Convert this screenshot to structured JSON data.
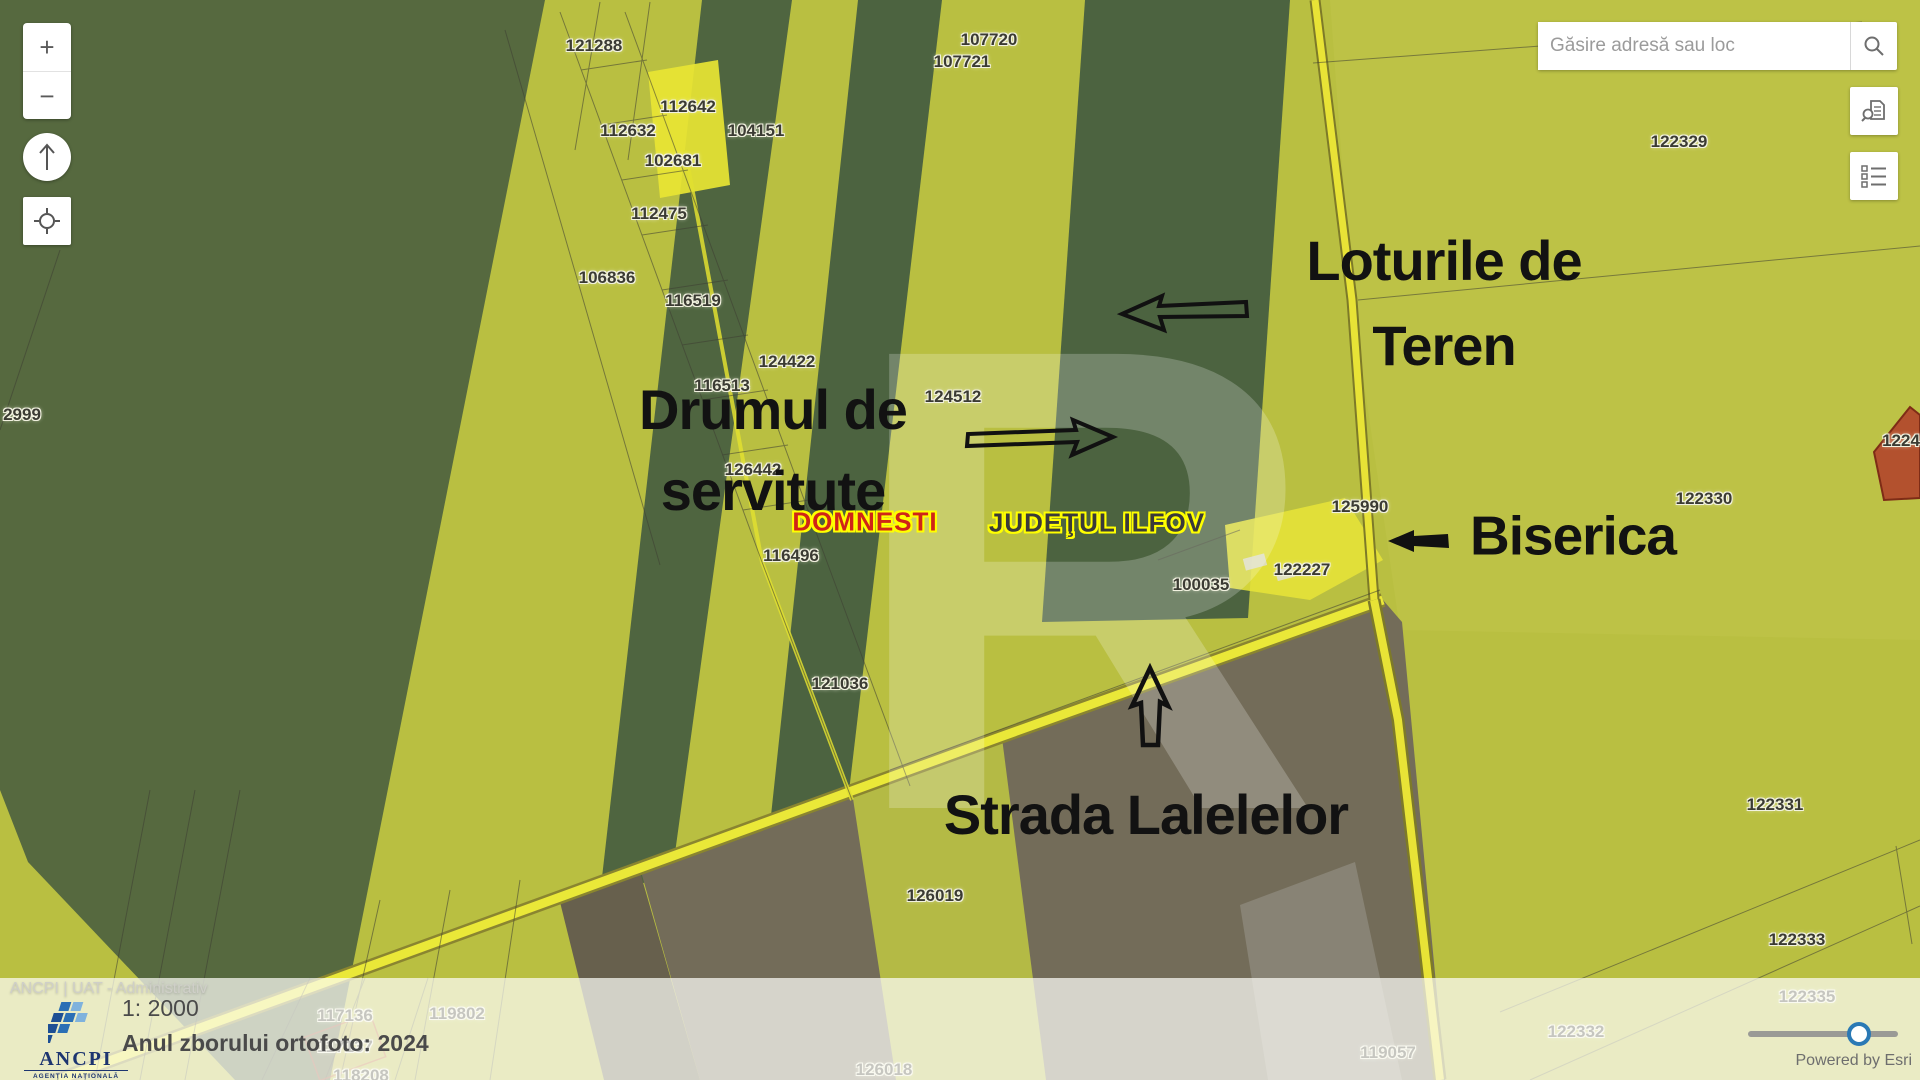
{
  "search": {
    "placeholder": "Găsire adresă sau loc"
  },
  "controls": {
    "zoom_in_label": "+",
    "zoom_out_label": "−",
    "icons": [
      "north-arrow-icon",
      "locate-icon",
      "search-icon",
      "doc-search-icon",
      "legend-icon"
    ]
  },
  "map": {
    "watermark_text": "R",
    "parcels": [
      {
        "n": "121288",
        "x": 594,
        "y": 46
      },
      {
        "n": "107720",
        "x": 989,
        "y": 40
      },
      {
        "n": "107721",
        "x": 962,
        "y": 62
      },
      {
        "n": "112642",
        "x": 688,
        "y": 107
      },
      {
        "n": "112632",
        "x": 628,
        "y": 131
      },
      {
        "n": "104151",
        "x": 756,
        "y": 131
      },
      {
        "n": "102681",
        "x": 673,
        "y": 161
      },
      {
        "n": "112475",
        "x": 659,
        "y": 214
      },
      {
        "n": "106836",
        "x": 607,
        "y": 278
      },
      {
        "n": "116519",
        "x": 693,
        "y": 301
      },
      {
        "n": "124422",
        "x": 787,
        "y": 362
      },
      {
        "n": "116513",
        "x": 722,
        "y": 386
      },
      {
        "n": "124512",
        "x": 953,
        "y": 397
      },
      {
        "n": "126442",
        "x": 753,
        "y": 470
      },
      {
        "n": "116496",
        "x": 791,
        "y": 556
      },
      {
        "n": "2999",
        "x": 22,
        "y": 415
      },
      {
        "n": "125990",
        "x": 1360,
        "y": 507
      },
      {
        "n": "122227",
        "x": 1302,
        "y": 570
      },
      {
        "n": "100035",
        "x": 1201,
        "y": 585
      },
      {
        "n": "121036",
        "x": 840,
        "y": 684
      },
      {
        "n": "126019",
        "x": 935,
        "y": 896
      },
      {
        "n": "122329",
        "x": 1679,
        "y": 142
      },
      {
        "n": "122330",
        "x": 1704,
        "y": 499
      },
      {
        "n": "1224",
        "x": 1901,
        "y": 441
      },
      {
        "n": "122331",
        "x": 1775,
        "y": 805
      },
      {
        "n": "122333",
        "x": 1797,
        "y": 940
      },
      {
        "n": "122335",
        "x": 1807,
        "y": 997
      },
      {
        "n": "122332",
        "x": 1576,
        "y": 1032
      },
      {
        "n": "119057",
        "x": 1388,
        "y": 1053
      },
      {
        "n": "126018",
        "x": 884,
        "y": 1070
      },
      {
        "n": "119802",
        "x": 457,
        "y": 1014
      },
      {
        "n": "117136",
        "x": 345,
        "y": 1016
      },
      {
        "n": "117137",
        "x": 345,
        "y": 1047
      },
      {
        "n": "118208",
        "x": 361,
        "y": 1076
      }
    ],
    "annotations": [
      {
        "id": "loturile-de-teren",
        "lines": [
          "Loturile de",
          "Teren"
        ],
        "x": 1444,
        "y": 303,
        "size": 56,
        "line_height": 85
      },
      {
        "id": "drumul-de-servitute",
        "lines": [
          "Drumul de",
          "servitute"
        ],
        "x": 773,
        "y": 450,
        "size": 56,
        "line_height": 81
      },
      {
        "id": "biserica",
        "lines": [
          "Biserica"
        ],
        "x": 1573,
        "y": 536,
        "size": 55,
        "line_height": 55
      },
      {
        "id": "strada-lalelelor",
        "lines": [
          "Strada Lalelelor"
        ],
        "x": 1146,
        "y": 815,
        "size": 56,
        "line_height": 56
      }
    ],
    "place_labels": [
      {
        "text": "DOMNESTI",
        "x": 865,
        "y": 522,
        "color": "#cf2418"
      },
      {
        "text": "JUDEŢUL ILFOV",
        "x": 1097,
        "y": 523,
        "color": "#3a3a3a"
      }
    ]
  },
  "attribution": {
    "sources": "ANCPI | UAT - Administrativ",
    "powered_by": "Powered by Esri"
  },
  "info_panel": {
    "scale": "1: 2000",
    "ortho_year": "Anul zborului ortofoto: 2024"
  },
  "logo": {
    "name": "ANCPI",
    "sub_lines": [
      "AGENŢIA NAŢIONALĂ",
      "DE CADASTRU ŞI",
      "PUBLICITATE IMOBILIARĂ"
    ]
  },
  "slider": {
    "position_pct": 71
  },
  "colors": {
    "field_chartreuse": "#b9bf41",
    "field_dark_green": "#52673f",
    "road_yellow": "#eae838",
    "field_brown": "#736c59",
    "red_parcel": "#b3512e",
    "slider_accent": "#2a79b5",
    "annotation_black": "#121212"
  }
}
